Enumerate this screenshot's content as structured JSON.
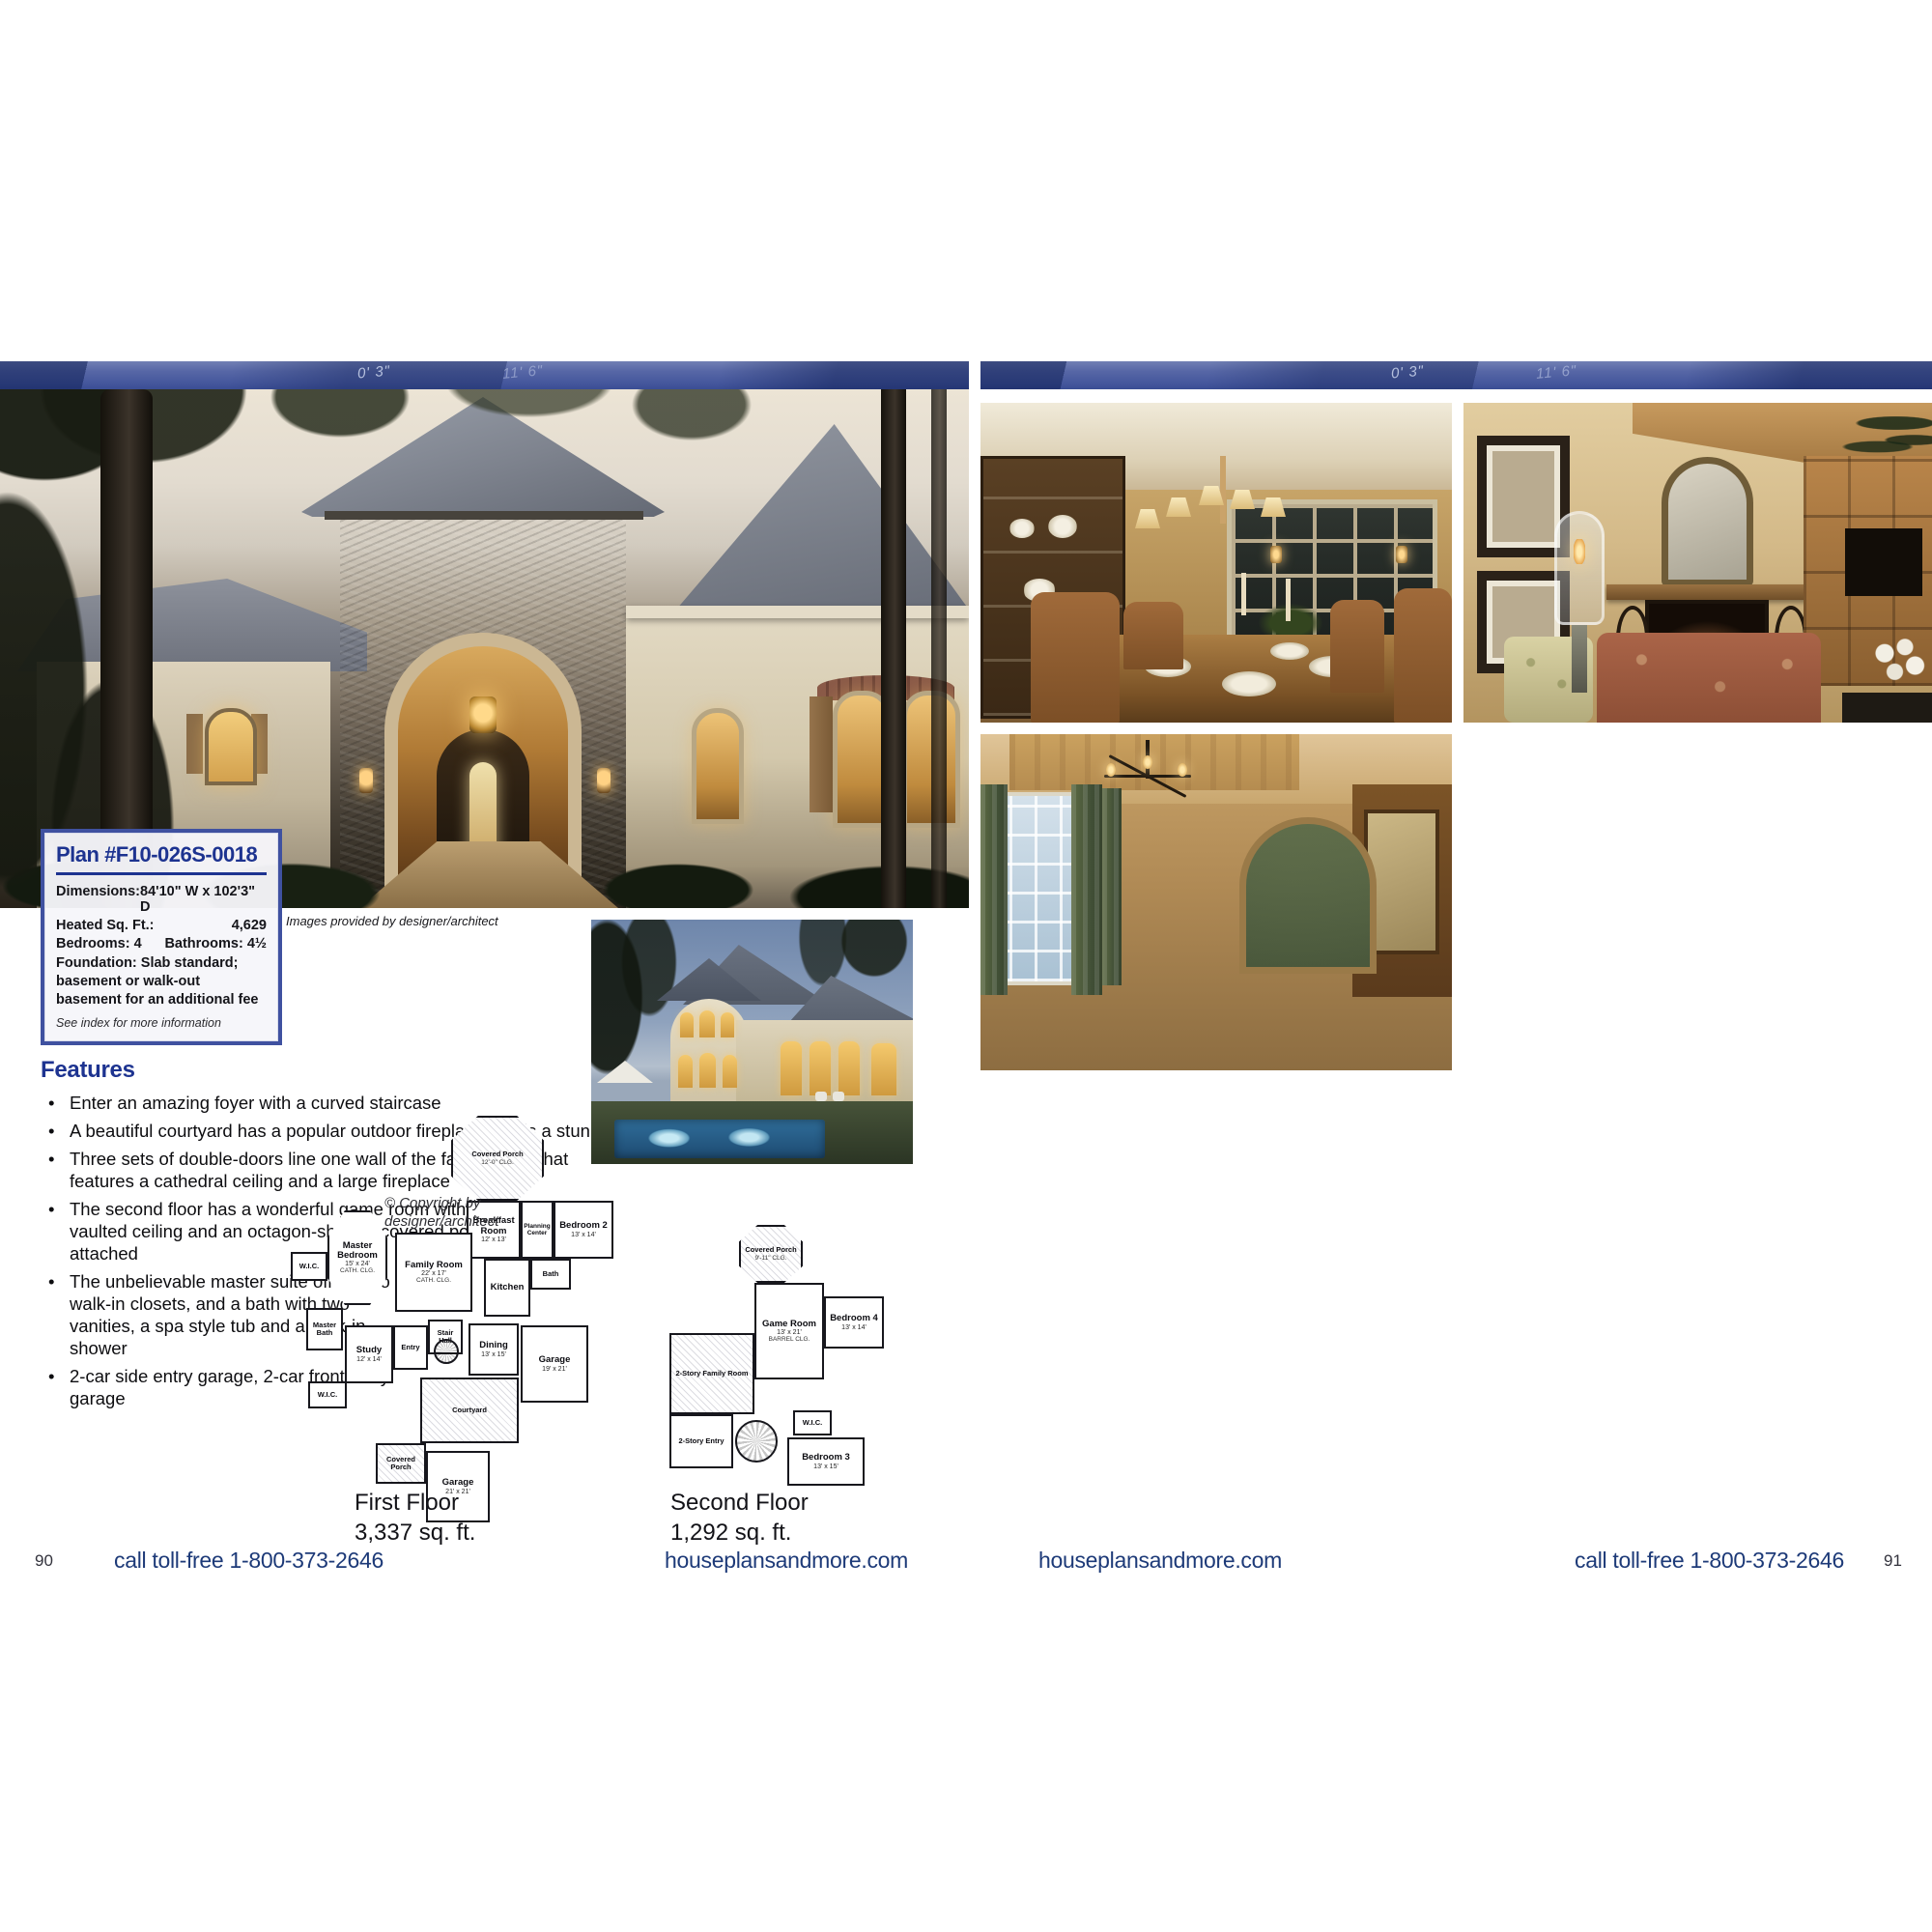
{
  "banner": {
    "marks": [
      "0' 3\"",
      "11' 6\""
    ]
  },
  "left_page": {
    "photo_caption": "Images provided by designer/architect",
    "plan_box": {
      "title": "Plan #F10-026S-0018",
      "dimensions_label": "Dimensions:",
      "dimensions_value": "84'10\" W x 102'3\" D",
      "heated_sqft_label": "Heated Sq. Ft.:",
      "heated_sqft_value": "4,629",
      "bedrooms": "Bedrooms: 4",
      "bathrooms": "Bathrooms: 4½",
      "foundation": "Foundation: Slab standard; basement or walk-out basement for an additional fee",
      "see_index": "See index for more information"
    },
    "features": {
      "heading": "Features",
      "items": [
        "Enter an amazing foyer with a curved staircase",
        "A beautiful courtyard has a popular outdoor fireplace that is a stunning focal point",
        "Three sets of double-doors line one wall of the family room that features a cathedral ceiling and a large fireplace",
        "The second floor has a wonderful game room with a barrel vaulted ceiling and an octagon-shaped covered porch attached",
        "The unbelievable master suite offers two walk-in closets, and a bath with two vanities, a spa style tub and a walk-in shower",
        "2-car side entry garage, 2-car front entry garage"
      ]
    },
    "floor_plans": {
      "copyright": "© Copyright by designer/architect",
      "first": {
        "caption_title": "First Floor",
        "caption_sqft": "3,337 sq. ft.",
        "rooms": [
          {
            "name": "Covered Porch",
            "note": "12'-0\" clg."
          },
          {
            "name": "Breakfast Room",
            "dim": "12' x 13'"
          },
          {
            "name": "Planning Center"
          },
          {
            "name": "Bedroom 2",
            "dim": "13' x 14'"
          },
          {
            "name": "Bath"
          },
          {
            "name": "Master Bedroom",
            "dim": "15' x 24'",
            "note": "cath. clg."
          },
          {
            "name": "Family Room",
            "dim": "22' x 17'",
            "note": "cath. clg."
          },
          {
            "name": "Kitchen"
          },
          {
            "name": "W.I.C."
          },
          {
            "name": "Master Bath"
          },
          {
            "name": "W.I.C."
          },
          {
            "name": "Study",
            "dim": "12' x 14'"
          },
          {
            "name": "Entry"
          },
          {
            "name": "Stair Hall"
          },
          {
            "name": "Dining",
            "dim": "13' x 15'"
          },
          {
            "name": "Garage",
            "dim": "19' x 21'"
          },
          {
            "name": "Courtyard"
          },
          {
            "name": "Covered Porch"
          },
          {
            "name": "Garage",
            "dim": "21' x 21'"
          }
        ]
      },
      "second": {
        "caption_title": "Second Floor",
        "caption_sqft": "1,292 sq. ft.",
        "rooms": [
          {
            "name": "Covered Porch",
            "note": "9'-11\" clg."
          },
          {
            "name": "Game Room",
            "dim": "13' x 21'",
            "note": "barrel clg."
          },
          {
            "name": "Bedroom 4",
            "dim": "13' x 14'"
          },
          {
            "name": "2-Story Family Room"
          },
          {
            "name": "2-Story Entry"
          },
          {
            "name": "W.I.C."
          },
          {
            "name": "Bedroom 3",
            "dim": "13' x 15'"
          }
        ]
      }
    },
    "footer": {
      "page_number": "90",
      "call": "call toll-free 1-800-373-2646",
      "site": "houseplansandmore.com"
    }
  },
  "right_page": {
    "footer": {
      "site": "houseplansandmore.com",
      "call": "call toll-free 1-800-373-2646",
      "page_number": "91"
    }
  }
}
